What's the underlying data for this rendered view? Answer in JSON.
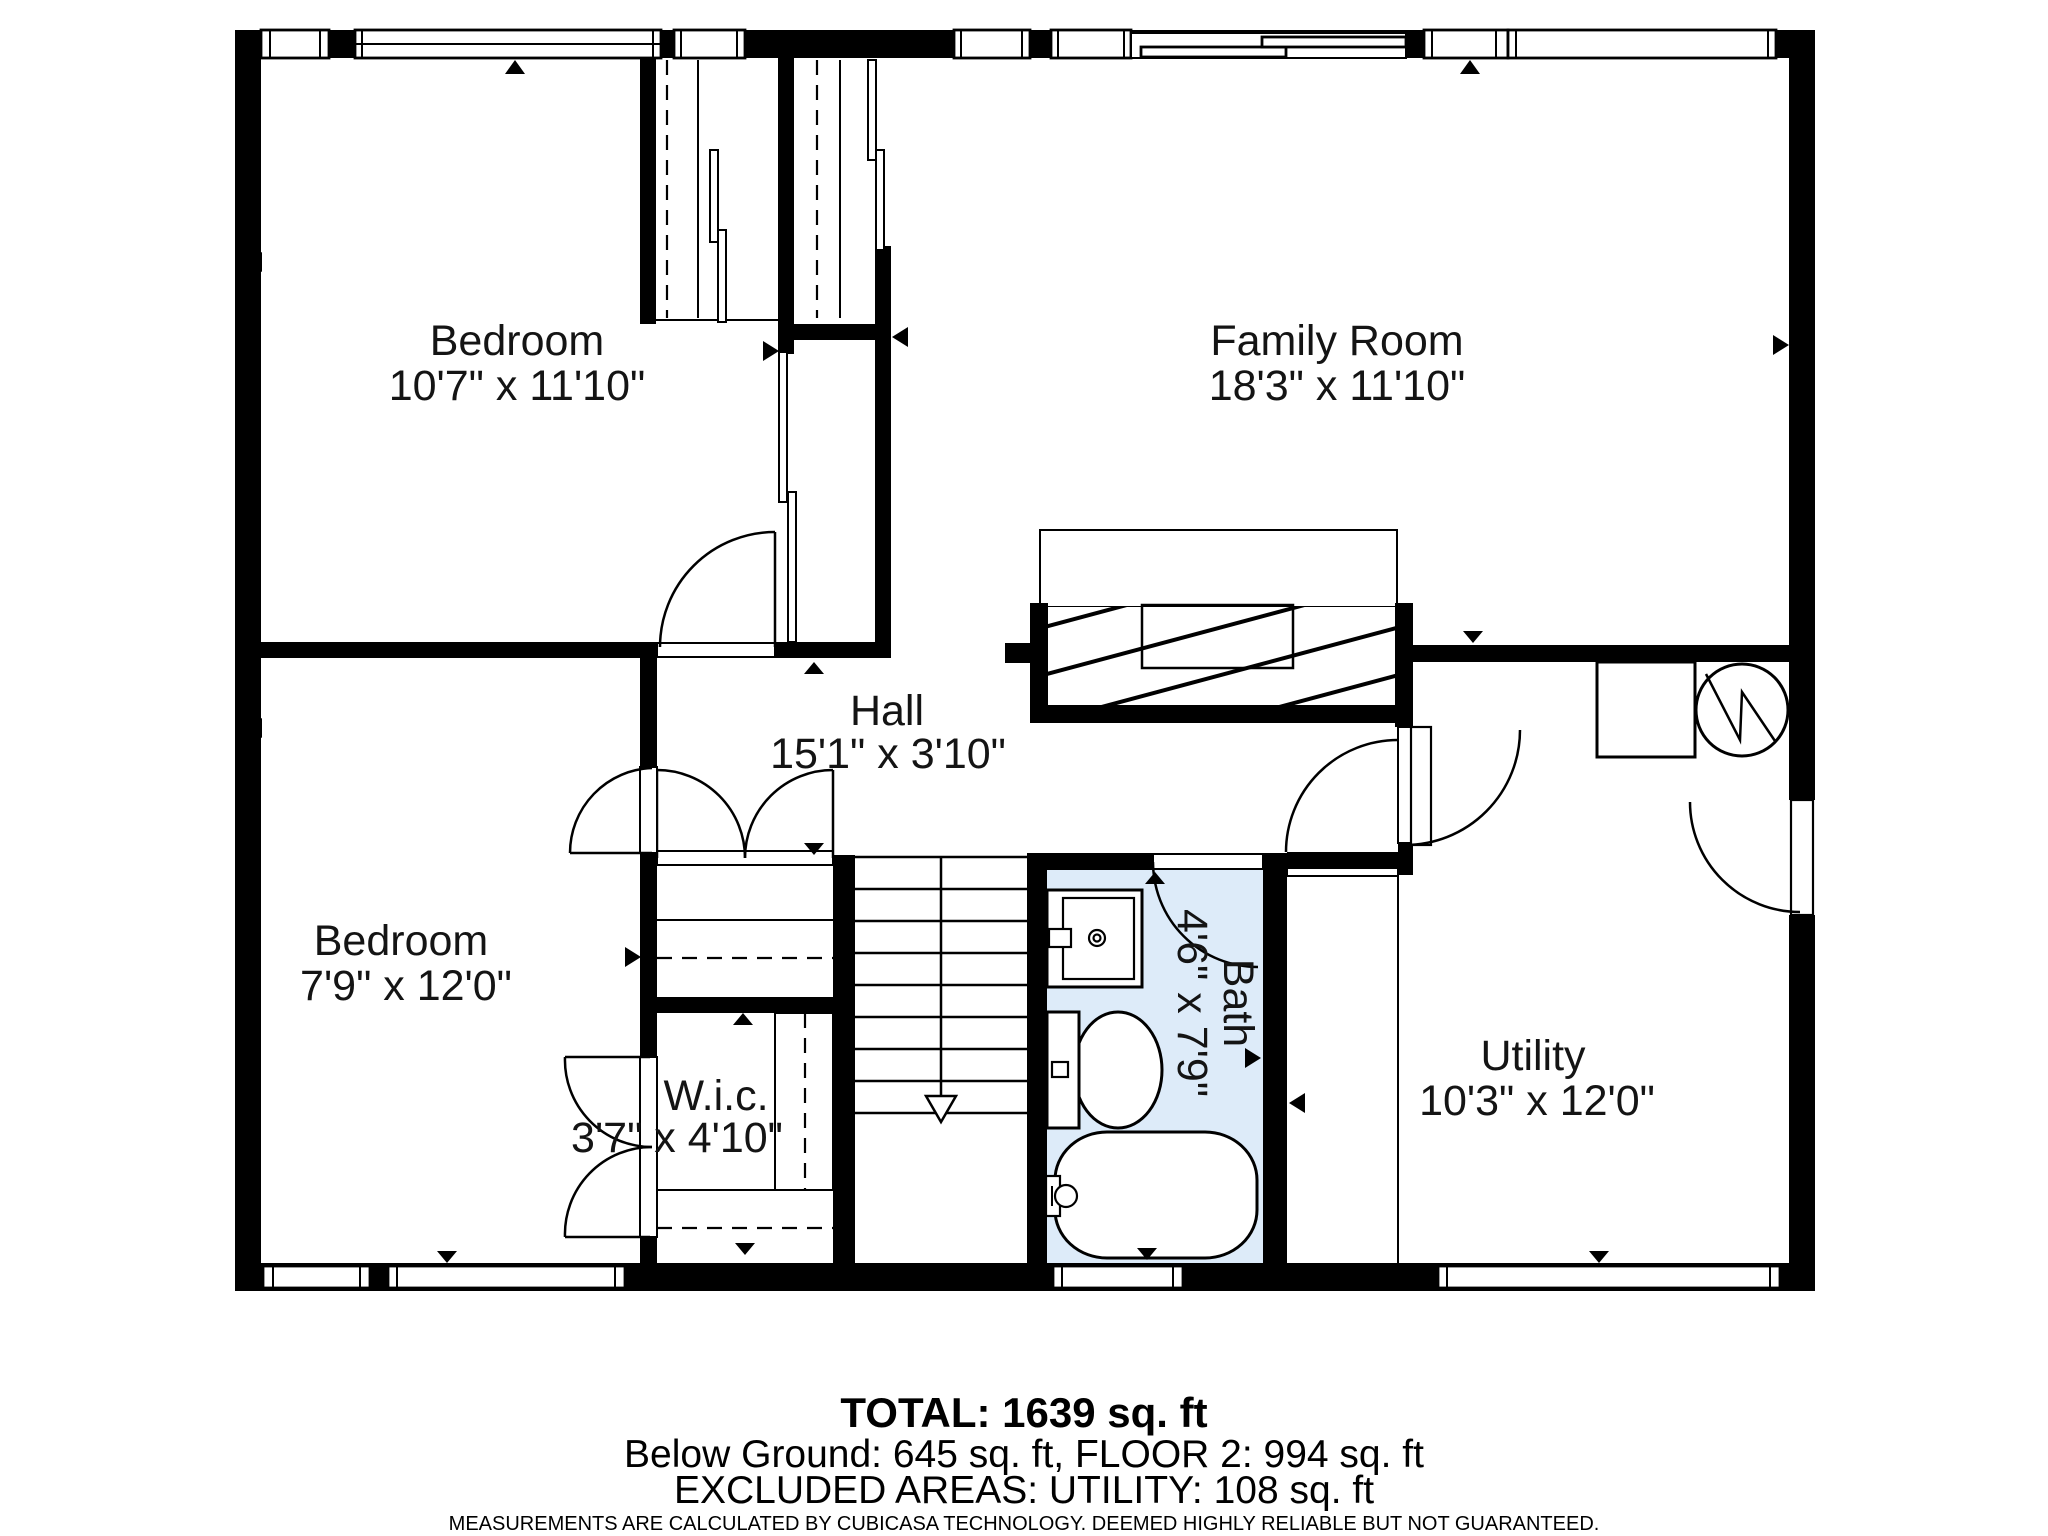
{
  "rooms": [
    {
      "name": "Bedroom",
      "dims": "10'7\" x 11'10\""
    },
    {
      "name": "Family Room",
      "dims": "18'3\" x 11'10\""
    },
    {
      "name": "Hall",
      "dims": "15'1\" x 3'10\""
    },
    {
      "name": "Bedroom",
      "dims": "7'9\" x 12'0\""
    },
    {
      "name": "W.i.c.",
      "dims": "3'7\" x 4'10\""
    },
    {
      "name": "Bath",
      "dims": "4'6\" x 7'9\""
    },
    {
      "name": "Utility",
      "dims": "10'3\" x 12'0\""
    }
  ],
  "footer": {
    "total": "TOTAL: 1639 sq. ft",
    "breakdown": "Below Ground: 645 sq. ft, FLOOR 2: 994 sq. ft",
    "excluded": "EXCLUDED AREAS: UTILITY: 108 sq. ft",
    "disclaimer": "MEASUREMENTS ARE CALCULATED BY CUBICASA TECHNOLOGY. DEEMED HIGHLY RELIABLE BUT NOT GUARANTEED."
  },
  "colors": {
    "wall": "#000000",
    "bath_fill": "#ddebf9",
    "background": "#ffffff"
  }
}
